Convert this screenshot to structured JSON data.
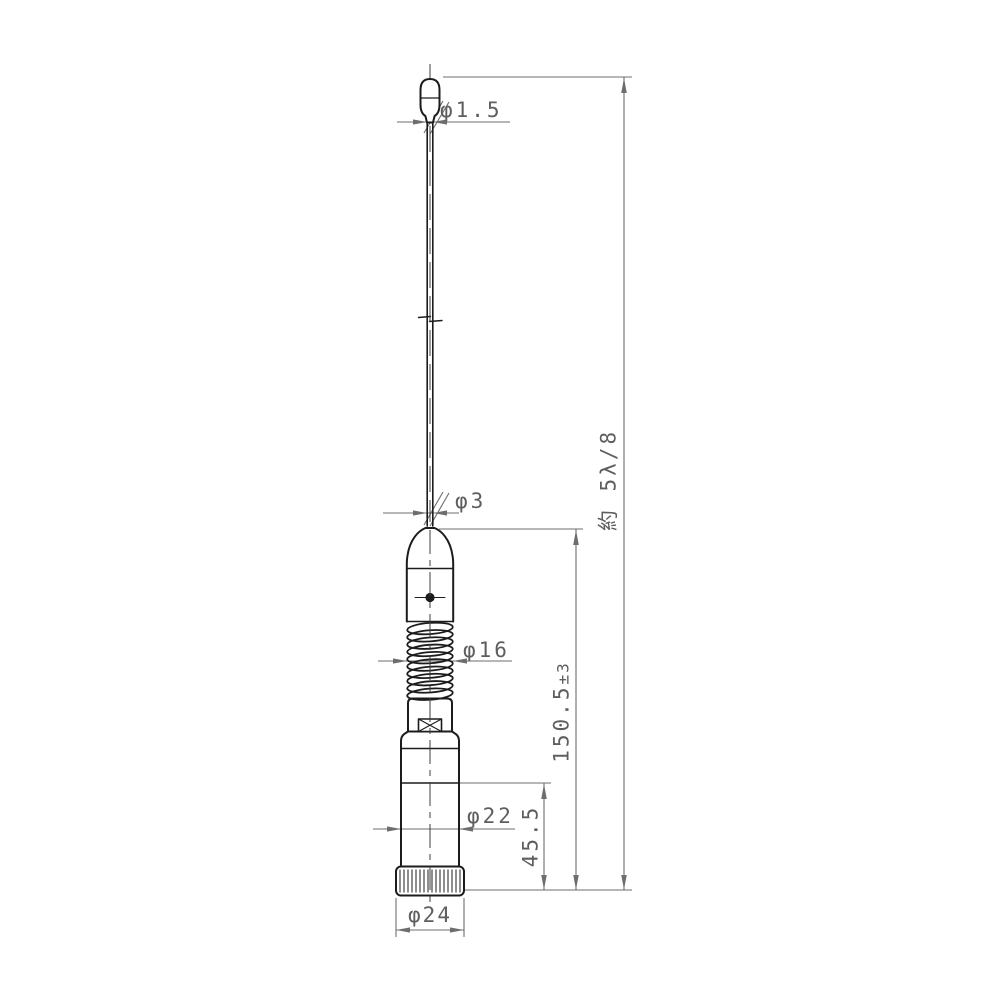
{
  "drawing": {
    "type": "technical-outline-drawing",
    "subject": "mobile whip antenna with loading coil and spring base",
    "dimensions": {
      "tip_diameter": "φ1.5",
      "whip_diameter": "φ3",
      "spring_diameter": "φ16",
      "body_diameter": "φ22",
      "base_diameter": "φ24",
      "lower_length_main": "150.5",
      "lower_length_tolerance": "±3",
      "base_length": "45.5",
      "overall_length": "約 5λ/8"
    },
    "colors": {
      "background": "#ffffff",
      "object_line": "#1c1c1c",
      "dimension_line": "#6e6e6e",
      "label_text": "#5e5e5e"
    }
  }
}
